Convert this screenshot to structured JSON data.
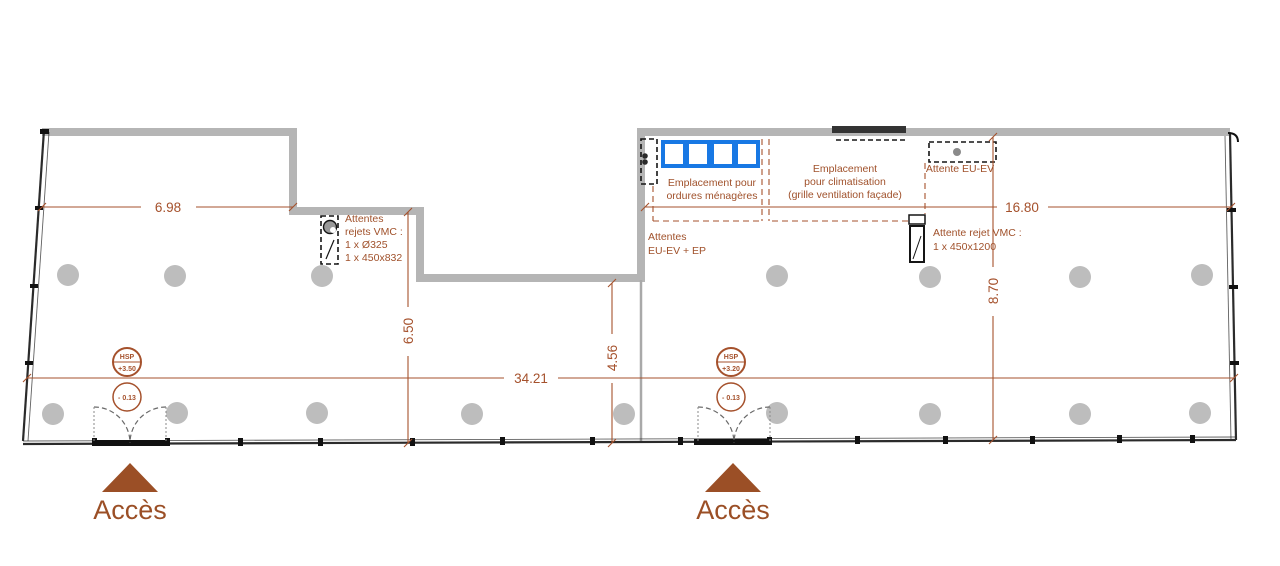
{
  "plan": {
    "dimensions": {
      "top_left_width": "6.98",
      "top_right_width": "16.80",
      "bottom_width": "34.21",
      "left_depth": "6.50",
      "mid_depth": "4.56",
      "right_depth": "8.70"
    },
    "levels": {
      "hsp_label": "HSP",
      "hsp_left_value": "+3.50",
      "hsp_right_value": "+3.20",
      "floor_level": "- 0.13"
    },
    "notes": {
      "vmc_left": {
        "l1": "Attentes",
        "l2": "rejets VMC :",
        "l3": "1 x Ø325",
        "l4": "1 x 450x832"
      },
      "ordures": {
        "l1": "Emplacement pour",
        "l2": "ordures ménagères"
      },
      "clim": {
        "l1": "Emplacement",
        "l2": "pour climatisation",
        "l3": "(grille ventilation façade)"
      },
      "attente_eu_ev": "Attente EU-EV",
      "attentes_eu_ev_ep": {
        "l1": "Attentes",
        "l2": "EU-EV + EP"
      },
      "vmc_right": {
        "l1": "Attente rejet VMC :",
        "l2": "1 x 450x1200"
      }
    },
    "access_left": "Accès",
    "access_right": "Accès",
    "colors": {
      "wall": "#b5b5b5",
      "dim": "#a5512c",
      "note": "#a0512b",
      "bins": "#1878e4",
      "columns": "#bdbdbd",
      "access": "#9b4f26"
    }
  }
}
